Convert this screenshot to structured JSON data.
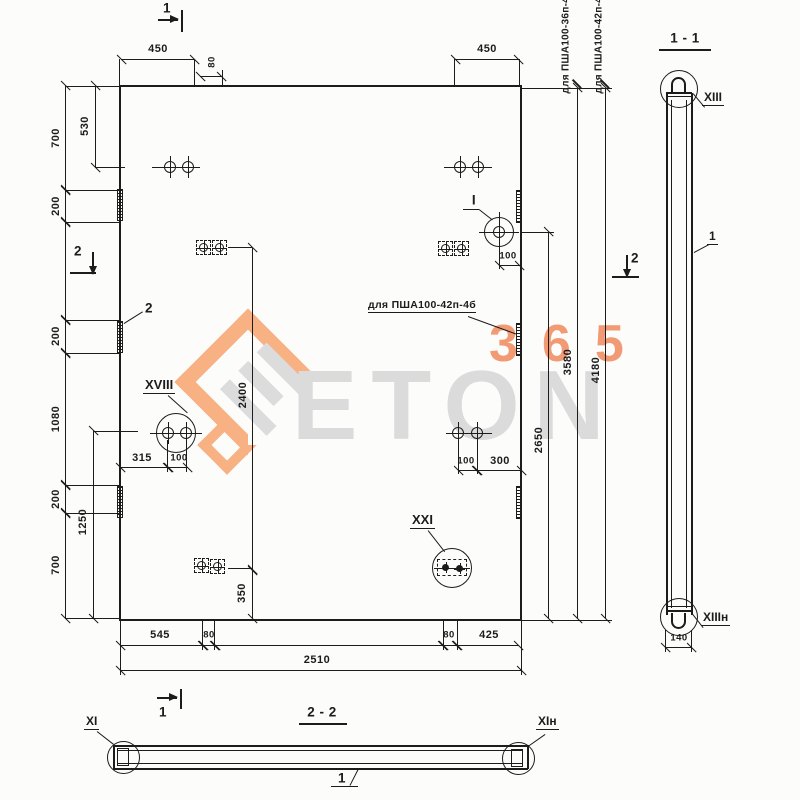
{
  "watermark": {
    "word": "ETON",
    "number": "365"
  },
  "plan": {
    "marks": {
      "top": "1",
      "bottom": "1",
      "left": "2",
      "right": "2"
    },
    "notes": {
      "variant36": "для ПША100-36п-4б",
      "variant42": "для ПША100-42п-4б",
      "variant42_mid": "для ПША100-42п-4б"
    },
    "details": {
      "i": "I",
      "xviii": "XVIII",
      "xxi": "XXI",
      "strip": "2"
    },
    "dims": {
      "top_450_left": "450",
      "top_80": "80",
      "top_450_right": "450",
      "left_700_top": "700",
      "left_530": "530",
      "left_200_top": "200",
      "left_200_mid": "200",
      "left_1080": "1080",
      "left_200_bot": "200",
      "left_1250": "1250",
      "left_700_bot": "700",
      "right_2650": "2650",
      "right_3580": "3580",
      "right_4180": "4180",
      "inner_100_top": "100",
      "inner_2400": "2400",
      "inner_350": "350",
      "inner_315": "315",
      "inner_100_xviii": "100",
      "inner_100_mid": "100",
      "inner_300": "300",
      "bottom_545": "545",
      "bottom_80_left": "80",
      "bottom_80_right": "80",
      "bottom_425": "425",
      "bottom_2510": "2510"
    }
  },
  "section11": {
    "title": "1 - 1",
    "top": "XIII",
    "bottom": "XIIIн",
    "dim140": "140",
    "bar": "1"
  },
  "section22": {
    "title": "2 - 2",
    "left": "XI",
    "right": "XIн",
    "bar": "1"
  }
}
